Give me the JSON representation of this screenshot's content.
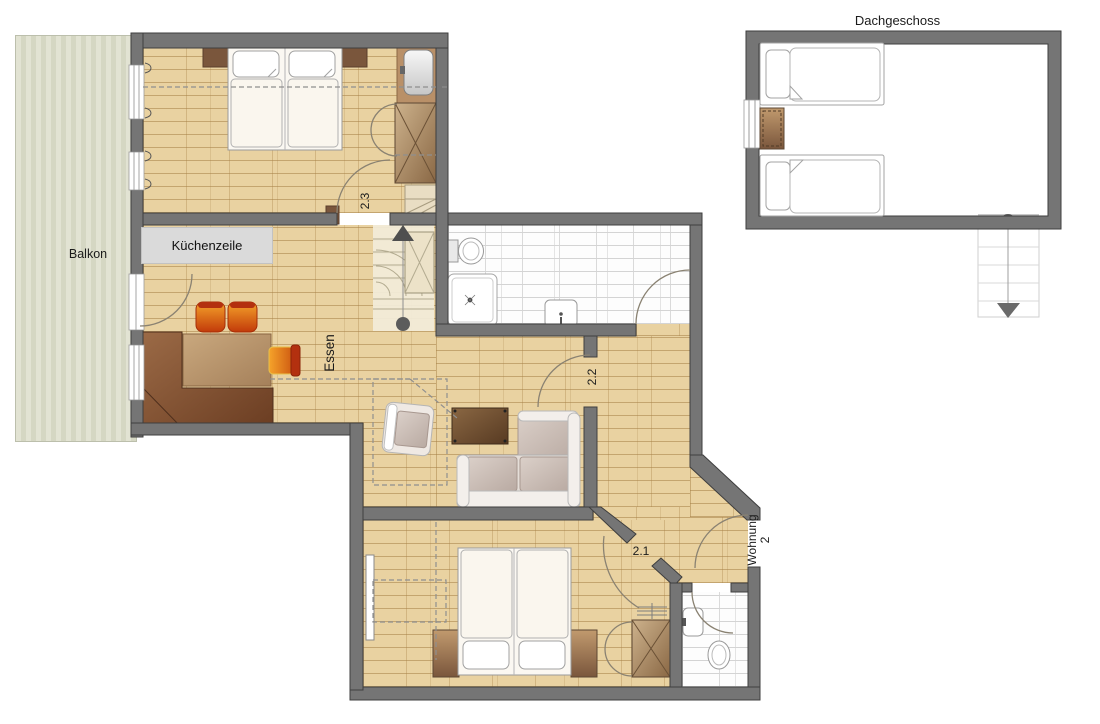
{
  "floorplan": {
    "attic": {
      "title": "Dachgeschoss"
    },
    "rooms": [
      {
        "id": "balcony",
        "label": "Balkon"
      },
      {
        "id": "kitchenette",
        "label": "Küchenzeile"
      },
      {
        "id": "dining",
        "label": "Essen"
      },
      {
        "id": "bedroom-23",
        "label": "2.3"
      },
      {
        "id": "room-22",
        "label": "2.2"
      },
      {
        "id": "bedroom-21",
        "label": "2.1"
      },
      {
        "id": "entrance",
        "label": "Wohnung 2"
      }
    ],
    "colors": {
      "wall": "#757575",
      "wall_outline": "#3e3e3e",
      "parquet": "#e9d2a1",
      "parquet_joint": "#a68046",
      "balcony_wood": "#dcdecb",
      "tile_background": "#fdfdfd",
      "tile_line": "#d4d4d4",
      "furniture_wood": "#8a6743",
      "furniture_dark_wood": "#7a563c",
      "upholstery": "#e0d8d1",
      "accent_orange": "#f09a2a",
      "accent_red": "#c23a0a",
      "stair_marker": "#5c5c5c"
    }
  }
}
